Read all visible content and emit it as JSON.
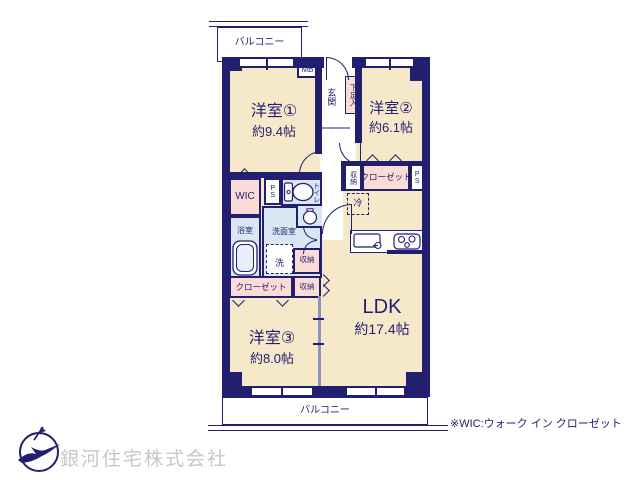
{
  "colors": {
    "wall": "#221e70",
    "room_cream": "#f6e9ca",
    "closet_pink": "#fadbd5",
    "water_blue": "#d9e6f3",
    "company_gray": "#c7c7cc"
  },
  "balcony_top": {
    "label": "バルコニー"
  },
  "balcony_bottom": {
    "label": "バルコニー"
  },
  "entry": {
    "mb": "MB",
    "genkan": "玄関",
    "shoe_box": "下足入"
  },
  "rooms": {
    "room1": {
      "name": "洋室①",
      "size": "約9.4帖"
    },
    "room2": {
      "name": "洋室②",
      "size": "約6.1帖"
    },
    "room3": {
      "name": "洋室③",
      "size": "約8.0帖"
    },
    "ldk": {
      "name": "LDK",
      "size": "約17.4帖"
    }
  },
  "storage": {
    "wic": "WIC",
    "ps_left": "PS",
    "ps_right": "PS",
    "toilet": "トイレ",
    "storage_right": "収納",
    "closet_right": "クローゼット",
    "fridge": "冷",
    "bath": "浴室",
    "washroom": "洗面室",
    "washer": "洗",
    "storage_mid_upper": "収納",
    "storage_mid_lower": "収納",
    "closet_left": "クローゼット"
  },
  "footer": {
    "wic_note": "※WIC:ウォーク イン クローゼット",
    "company": "銀河住宅株式会社"
  }
}
